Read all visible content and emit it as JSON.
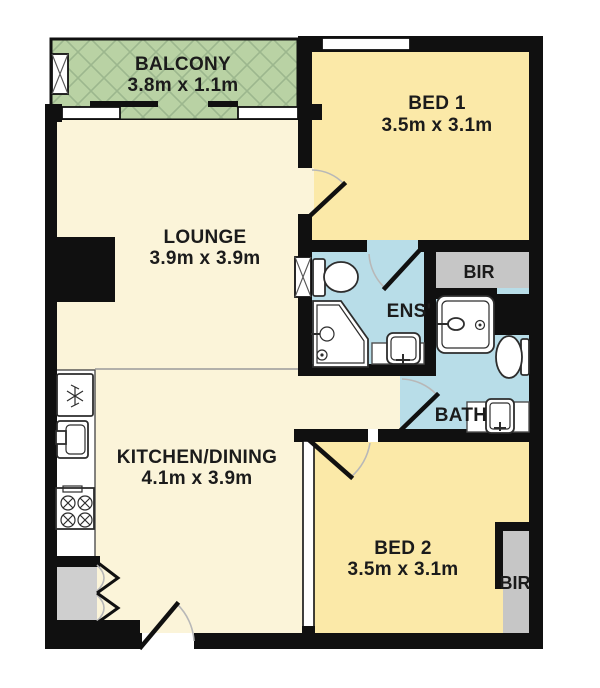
{
  "rooms": {
    "balcony": {
      "name": "BALCONY",
      "dims": "3.8m x 1.1m"
    },
    "bed1": {
      "name": "BED 1",
      "dims": "3.5m x 3.1m"
    },
    "lounge": {
      "name": "LOUNGE",
      "dims": "3.9m x 3.9m"
    },
    "ens": {
      "name": "ENS'"
    },
    "bir1": {
      "name": "BIR"
    },
    "bath": {
      "name": "BATH"
    },
    "kitchen": {
      "name": "KITCHEN/DINING",
      "dims": "4.1m x 3.9m"
    },
    "bed2": {
      "name": "BED 2",
      "dims": "3.5m x 3.1m"
    },
    "bir2": {
      "name": "BIR"
    }
  },
  "colors": {
    "wall": "#101010",
    "bedroom": "#fbe9a8",
    "living": "#fbf4d9",
    "wet": "#b8dde8",
    "balcony": "#b9d2a4",
    "balcony_hatch": "#9cb78e",
    "robe": "#c6c6c6",
    "closet": "#cfcfcf",
    "outline": "#2d2d2d",
    "label": "#1b1b1b",
    "arc": "#b8b8b8",
    "divider": "#9a9a9a",
    "bg": "#ffffff"
  }
}
